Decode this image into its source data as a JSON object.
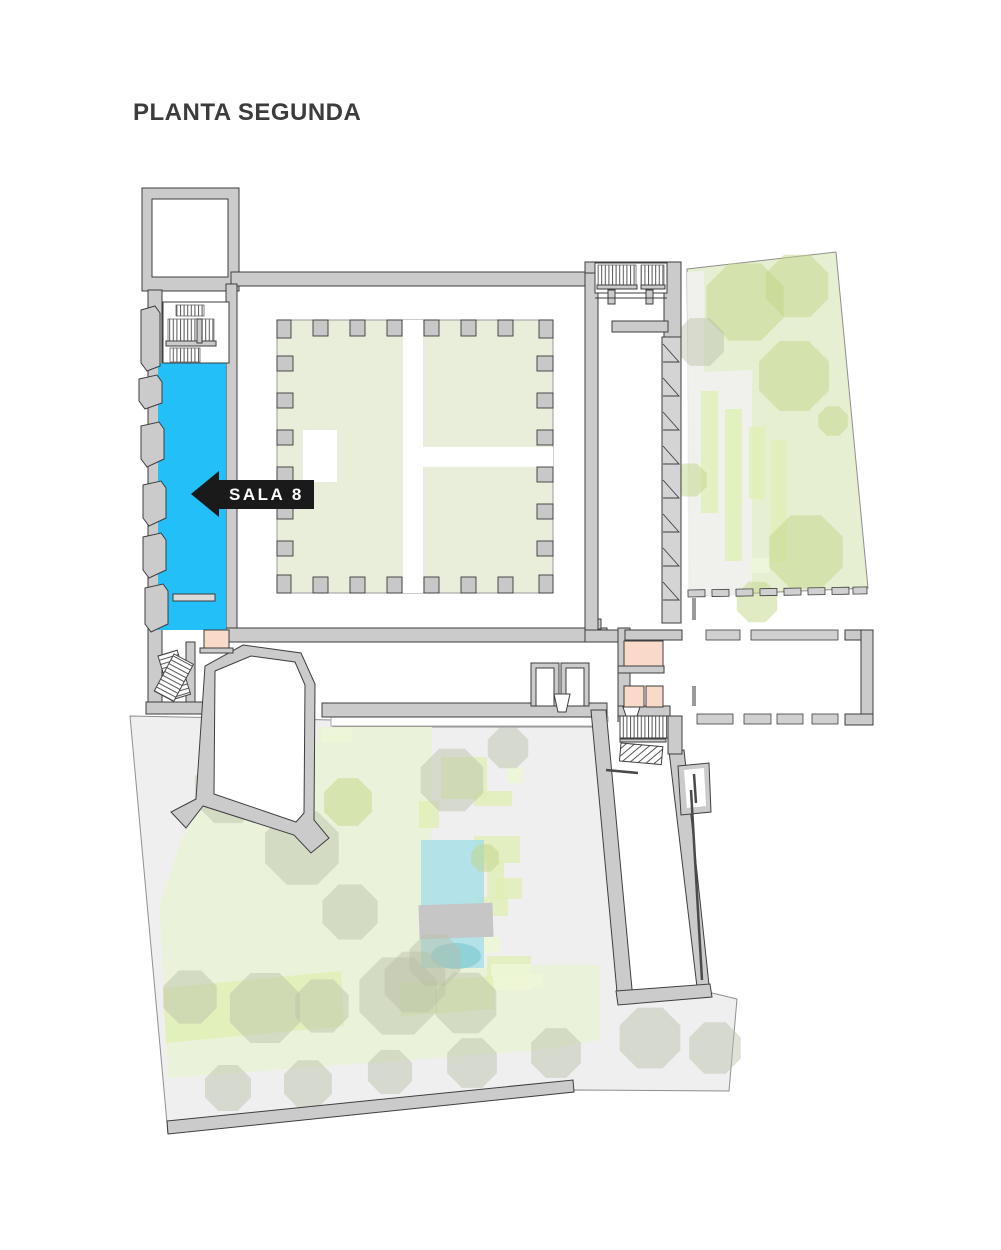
{
  "page": {
    "title": "PLANTA SEGUNDA",
    "background": "#FFFFFF"
  },
  "floor_plan": {
    "highlighted_room": {
      "name": "SALA 8",
      "arrow_direction": "left",
      "room_color": "#22BFF9",
      "label_background": "#1A1A1A",
      "label_text_color": "#FFFFFF"
    },
    "palette": {
      "walls": "#CBCBCB",
      "wall_outline": "#3E3E3E",
      "courtyard_green": "#E9EEDB",
      "east_garden_green": "#E6EFD2",
      "south_garden_gray": "#EFEFEF",
      "planting_green": "#EAF3D9",
      "tree_green": "#C2D687",
      "tree_olive": "#B9BFA6",
      "pool_blue": "#A5DEE7",
      "service_room_pink": "#F9D9C7"
    }
  }
}
